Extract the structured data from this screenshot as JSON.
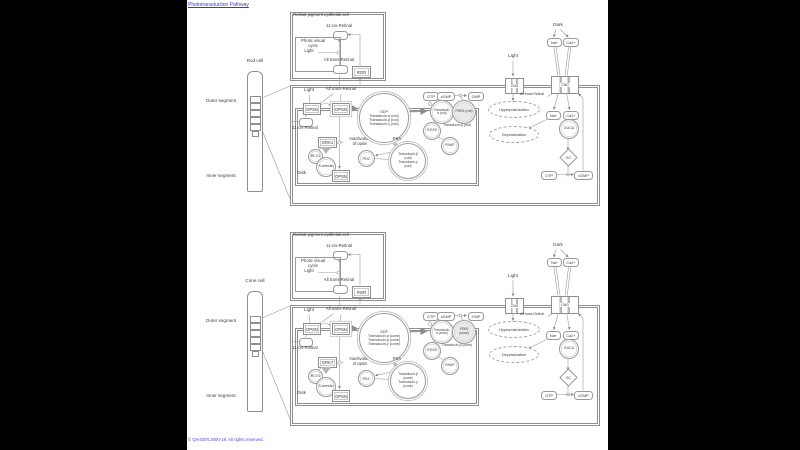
{
  "page": {
    "title": "Phototransduction Pathway",
    "copyright": "© QIAGEN 2000-19. All rights reserved.",
    "colors": {
      "background": "#000000",
      "canvas": "#ffffff",
      "link": "#3a3ac6",
      "line": "#9a9a9a",
      "text": "#3c3c3c"
    }
  },
  "panels": {
    "rod": {
      "cell_label": "Rod cell",
      "outer_segment_label": "Outer segment",
      "inner_segment_label": "Inner segment",
      "rpe_title": "Retinal pigment epithelial cell",
      "rpe_retinal11": "11-cis-Retinal",
      "rpe_cycle": "Photic visual\ncycle",
      "rpe_light": "Light",
      "rpe_retinal_at": "All trans-Retinal",
      "rpe_rgr": "RGR",
      "light": "Light",
      "all_trans": "All trans-Retinal",
      "opsn_a": "OPSN",
      "opsn_b": "OPSN",
      "retinal11": "11-cis-Retinal",
      "grk": "GRK1",
      "rcv": "RCV1",
      "inactivation": "Inactivation\nof opsin",
      "arrestin": "S-arrestin",
      "opsn_p": "OPSN",
      "disk_label": "Disk",
      "gdp": "GDP",
      "complex1_l1": "Transducin-α (rod)",
      "complex1_l2": "Transducin-β (rod)",
      "complex1_l3": "Transducin-γ (rod)",
      "pka": "PKA",
      "pdc": "PDC",
      "complex2_l1": "Transducin-β (rod)",
      "complex2_l2": "Transducin-γ (rod)",
      "gtp": "GTP",
      "t_alpha": "Transducin-α (rod)",
      "pde": "PDE6 (rod)",
      "cgmp_a": "cGMP",
      "gmp": "GMP",
      "rgs9": "RGS9",
      "t_beta5": "Transducin-β (rod)",
      "r9ap": "R9AP",
      "cng_l": "CNG",
      "cng_r": "CNG",
      "light2": "Light",
      "hyperpolarization": "Hyperpolarization",
      "all_trans2": "All trans-Retinal",
      "dark": "Dark",
      "na_out": "Na+",
      "ca_out": "Ca2+",
      "na_in": "Na+",
      "ca_in": "Ca2+",
      "depolarization": "Depolarization",
      "guca": "GUCA",
      "gc": "GC",
      "gtp2": "GTP",
      "cgmp_b": "cGMP"
    },
    "cone": {
      "cell_label": "Cone cell",
      "outer_segment_label": "Outer segment",
      "inner_segment_label": "Inner segment",
      "rpe_title": "Retinal pigment epithelial cell",
      "rpe_retinal11": "11-cis-Retinal",
      "rpe_cycle": "Photic visual\ncycle",
      "rpe_light": "Light",
      "rpe_retinal_at": "All trans-Retinal",
      "rpe_rgr": "RGR",
      "light": "Light",
      "all_trans": "All trans-Retinal",
      "opsn_a": "OPSN",
      "opsn_b": "OPSN",
      "retinal11": "11-cis-Retinal",
      "grk": "GRK7",
      "rcv": "RCV1",
      "inactivation": "Inactivation\nof opsin",
      "arrestin": "S-arrestin",
      "opsn_p": "OPSN",
      "disk_label": "Disk",
      "gdp": "GDP",
      "complex1_l1": "Transducin-α (cone)",
      "complex1_l2": "Transducin-β (cone)",
      "complex1_l3": "Transducin-γ (cone)",
      "pka": "PKA",
      "pdc": "PDC",
      "complex2_l1": "Transducin-β (cone)",
      "complex2_l2": "Transducin-γ (cone)",
      "gtp": "GTP",
      "t_alpha": "Transducin-α (cone)",
      "pde": "PDE6 (cone)",
      "cgmp_a": "cGMP",
      "gmp": "GMP",
      "rgs9": "RGS9",
      "t_beta5": "Transducin-β (cone)",
      "r9ap": "R9AP",
      "cng_l": "CNG",
      "cng_r": "CNG",
      "light2": "Light",
      "hyperpolarization": "Hyperpolarization",
      "all_trans2": "All trans-Retinal",
      "dark": "Dark",
      "na_out": "Na+",
      "ca_out": "Ca2+",
      "na_in": "Na+",
      "ca_in": "Ca2+",
      "depolarization": "Depolarization",
      "guca": "GUCA",
      "gc": "GC",
      "gtp2": "GTP",
      "cgmp_b": "cGMP"
    }
  }
}
